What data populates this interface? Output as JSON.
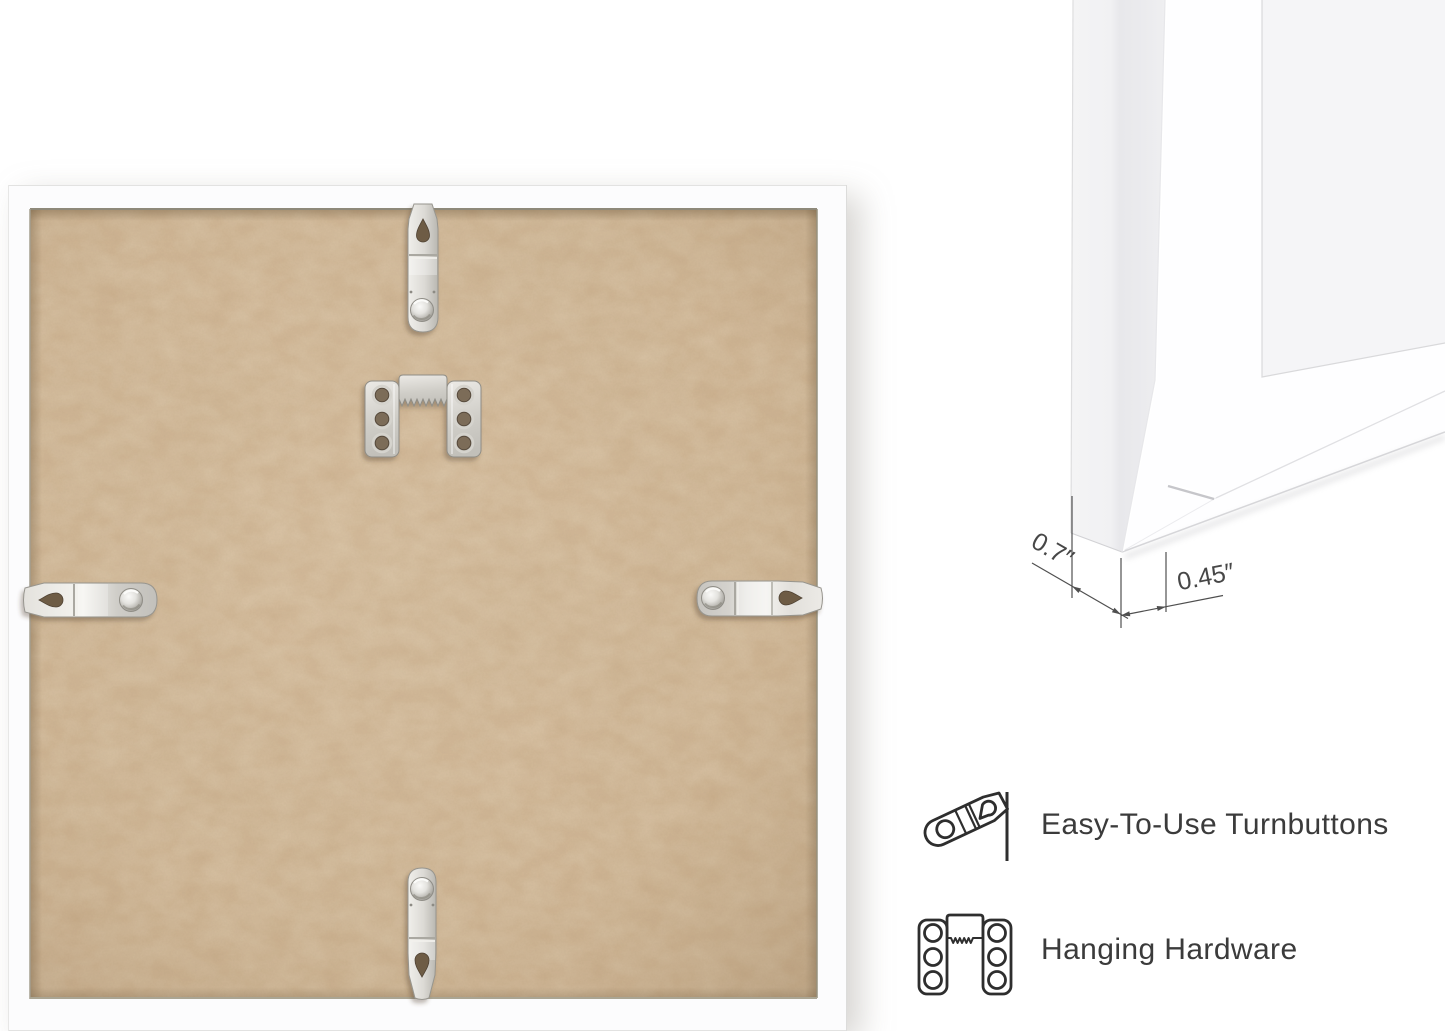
{
  "dimensions": {
    "depth_label": "0.7″",
    "face_width_label": "0.45″"
  },
  "features": [
    {
      "icon": "turnbutton-icon",
      "label": "Easy-To-Use Turnbuttons"
    },
    {
      "icon": "hanging-hardware-icon",
      "label": "Hanging Hardware"
    }
  ],
  "colors": {
    "background": "#ffffff",
    "frame_white": "#fcfcfd",
    "mdf_base": "#cdb18f",
    "mdf_dark_speck": "#6b5335",
    "mdf_light_streak": "#efe0c0",
    "metal_light": "#f2f1ed",
    "metal_mid": "#d8d6d1",
    "metal_dark": "#a3a19b",
    "hole_shadow": "#6e5c44",
    "caption_text": "#3b3b3b",
    "dimension_line": "#4f4f4f"
  }
}
